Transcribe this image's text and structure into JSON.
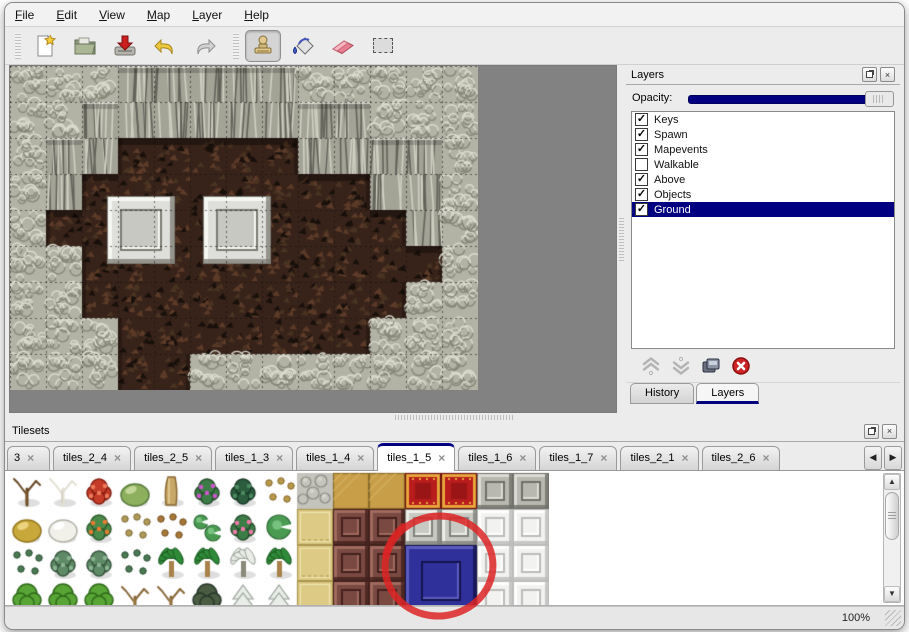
{
  "menu": {
    "items": [
      "File",
      "Edit",
      "View",
      "Map",
      "Layer",
      "Help"
    ]
  },
  "toolbar": {
    "buttons": [
      {
        "name": "new-map"
      },
      {
        "name": "open-map"
      },
      {
        "name": "save-map"
      },
      {
        "name": "undo"
      },
      {
        "name": "redo"
      },
      {
        "name": "stamp-tool"
      },
      {
        "name": "fill-tool"
      },
      {
        "name": "eraser-tool"
      },
      {
        "name": "select-tool"
      }
    ],
    "active_tool": "stamp-tool"
  },
  "layers_panel": {
    "title": "Layers",
    "opacity_label": "Opacity:",
    "items": [
      {
        "label": "Keys",
        "checked": true,
        "selected": false
      },
      {
        "label": "Spawn",
        "checked": true,
        "selected": false
      },
      {
        "label": "Mapevents",
        "checked": true,
        "selected": false
      },
      {
        "label": "Walkable",
        "checked": false,
        "selected": false
      },
      {
        "label": "Above",
        "checked": true,
        "selected": false
      },
      {
        "label": "Objects",
        "checked": true,
        "selected": false
      },
      {
        "label": "Ground",
        "checked": true,
        "selected": true
      }
    ],
    "buttons": [
      {
        "name": "move-layer-up",
        "disabled": true
      },
      {
        "name": "move-layer-down",
        "disabled": true
      },
      {
        "name": "duplicate-layer",
        "disabled": false
      },
      {
        "name": "delete-layer",
        "disabled": false
      }
    ],
    "tabs": [
      "History",
      "Layers"
    ],
    "active_tab": "Layers"
  },
  "tilesets_panel": {
    "title": "Tilesets",
    "tabs": [
      {
        "label": "3",
        "narrow": true
      },
      {
        "label": "tiles_2_4"
      },
      {
        "label": "tiles_2_5"
      },
      {
        "label": "tiles_1_3"
      },
      {
        "label": "tiles_1_4"
      },
      {
        "label": "tiles_1_5"
      },
      {
        "label": "tiles_1_6"
      },
      {
        "label": "tiles_1_7"
      },
      {
        "label": "tiles_2_1"
      },
      {
        "label": "tiles_2_6"
      }
    ],
    "active_tab": "tiles_1_5"
  },
  "statusbar": {
    "zoom": "100%"
  },
  "glyphs": {
    "close": "×",
    "check": "✓",
    "left": "◀",
    "right": "▶",
    "up": "▲",
    "down": "▼"
  },
  "map": {
    "tile_size": 36,
    "grid": [
      "GGGCCCCCGGGGG",
      "GGCCCCCCCCGGG",
      "GCCBBBBBCCCCG",
      "GCBBBBBBBBCCG",
      "GBBBBBBBBBBCG",
      "GGBBBBBBBBBBG",
      "GGBBBBBBBBBGG",
      "GGGBBBBBBBGGG",
      "GGGBBGGGGGGGG"
    ],
    "pillars": [
      {
        "x": 97,
        "y": 130
      },
      {
        "x": 193,
        "y": 130
      }
    ],
    "pillar_size": 68,
    "colors": {
      "rock": "#b3b3a5",
      "rock_dark": "#87877a",
      "rock_light": "#dcdccf",
      "cliff": "#a3a396",
      "cliff_dark": "#63635a",
      "cliff_light": "#cfcfc2",
      "floor": "#38231a",
      "floor_light": "#5d3b28",
      "floor_mid": "#4a3322",
      "floor_dark": "#17100b",
      "void": "#828282",
      "grid": "rgba(15,15,15,0.55)",
      "pillar_face": "#dededa",
      "pillar_mid": "#c8c8c2",
      "pillar_light": "#f6f6f2",
      "pillar_dark": "#7c7c74"
    }
  },
  "tileset": {
    "tile_size": 36,
    "rows": [
      [
        "dead",
        "whitetree",
        "red",
        "stump",
        "trunk",
        "purple",
        "fern",
        "sprout",
        "cobble",
        "wood",
        "wood",
        "carpet",
        "carpet",
        "grayt",
        "grayt"
      ],
      [
        "hay",
        "snowmound",
        "orange",
        "dry",
        "leaves",
        "lily",
        "pink",
        "lilybig",
        "mat",
        "brown",
        "brown",
        "grayblk",
        "grayblk",
        "whiteblk",
        "whiteblk"
      ],
      [
        "sprigs",
        "bush",
        "bush",
        "sprigs",
        "palm",
        "palm",
        "palmsnow",
        "palm",
        "mat",
        "brown",
        "brown",
        "skip",
        "skip",
        "whiteblk",
        "whiteblk"
      ],
      [
        "gtree",
        "gtree",
        "gtree",
        "twist",
        "twist",
        "dtree",
        "firsnow",
        "firsnow",
        "mat",
        "brown",
        "brown",
        "skip",
        "skip",
        "whiteblk",
        "whiteblk"
      ]
    ],
    "blocks": [
      {
        "col": 11,
        "row": 2,
        "w": 2,
        "h": 2,
        "kind": "blue"
      }
    ],
    "kinds": {
      "dead": {
        "shape": "bare",
        "c1": "#6b4a26",
        "c2": "#3f2a12",
        "c3": "#8a6a3a"
      },
      "whitetree": {
        "shape": "bare",
        "c1": "#e4e0d4",
        "c2": "#a8a49a",
        "c3": "#c8c4b8"
      },
      "red": {
        "shape": "blob",
        "c1": "#c43c28",
        "c2": "#821c10",
        "c3": "#ee7a5a"
      },
      "stump": {
        "shape": "mound",
        "c1": "#8cb05e",
        "c2": "#55783a",
        "c3": "#c2d698"
      },
      "trunk": {
        "shape": "trunkv",
        "c1": "#c8a868",
        "c2": "#8a6a34",
        "c3": "#e6d098"
      },
      "purple": {
        "shape": "blob",
        "c1": "#3c7c46",
        "c2": "#234d2a",
        "c3": "#cc58cc"
      },
      "fern": {
        "shape": "blob",
        "c1": "#2c5c3e",
        "c2": "#183826",
        "c3": "#4a8a5e"
      },
      "sprout": {
        "shape": "sprigs",
        "c1": "#b89a4a",
        "c2": "#86692a",
        "c3": "#d8c27a"
      },
      "hay": {
        "shape": "mound",
        "c1": "#c8a83a",
        "c2": "#93751c",
        "c3": "#ecd47e"
      },
      "snowmound": {
        "shape": "mound",
        "c1": "#f1f1ea",
        "c2": "#b2b2a8",
        "c3": "#ffffff"
      },
      "orange": {
        "shape": "blob",
        "c1": "#4a8a4a",
        "c2": "#2b5a2b",
        "c3": "#e87c30"
      },
      "dry": {
        "shape": "sprigs",
        "c1": "#b09a5a",
        "c2": "#7e6a34",
        "c3": "#d4c088"
      },
      "leaves": {
        "shape": "sprigs",
        "c1": "#a87838",
        "c2": "#74501e",
        "c3": "#cc9c5c"
      },
      "lily": {
        "shape": "lily",
        "c1": "#4a9a52",
        "c2": "#2c6a34",
        "c3": "#78c280"
      },
      "pink": {
        "shape": "blob",
        "c1": "#3c7c46",
        "c2": "#234d2a",
        "c3": "#ee7aa8"
      },
      "lilybig": {
        "shape": "lilybig",
        "c1": "#4a9a52",
        "c2": "#2c6a34",
        "c3": "#78c280"
      },
      "bush": {
        "shape": "blob",
        "c1": "#5e8a66",
        "c2": "#35523c",
        "c3": "#8ab492"
      },
      "sprigs": {
        "shape": "sprigs",
        "c1": "#4a7a52",
        "c2": "#2c4e34",
        "c3": "#74a47c"
      },
      "palm": {
        "shape": "palm",
        "c1": "#2f8a38",
        "c2": "#1a5a20",
        "c3": "#a8824a"
      },
      "palmsnow": {
        "shape": "palm",
        "c1": "#e9ede6",
        "c2": "#9aa29a",
        "c3": "#8a8a7a"
      },
      "gtree": {
        "shape": "tree",
        "c1": "#58a434",
        "c2": "#2f6a1a",
        "c3": "#7a5a33"
      },
      "dtree": {
        "shape": "tree",
        "c1": "#4a5c42",
        "c2": "#28362a",
        "c3": "#56462e"
      },
      "twist": {
        "shape": "bare",
        "c1": "#8a6a3a",
        "c2": "#54401e",
        "c3": "#b09058"
      },
      "firsnow": {
        "shape": "fir",
        "c1": "#e9ede8",
        "c2": "#9aa29a",
        "c3": "#3a5a3c"
      },
      "cobble": {
        "shape": "cobble",
        "c1": "#c4c4bc",
        "c2": "#8a8a82",
        "c3": "#e4e4dc"
      },
      "wood": {
        "shape": "tile",
        "c1": "#c89e48",
        "c2": "#8a6a28",
        "c3": "#e2c678"
      },
      "mat": {
        "shape": "mat",
        "c1": "#ddca84",
        "c2": "#ab9750",
        "c3": "#f0e3b0"
      },
      "brown": {
        "shape": "bevel",
        "face": "#7a4a42",
        "mid": "#6a3e38",
        "dark": "#43211d",
        "light": "#a06a5e"
      },
      "carpet": {
        "shape": "carpet",
        "c1": "#b81c1c",
        "c2": "#6e0e0e",
        "c3": "#e8a83c"
      },
      "grayt": {
        "shape": "bevel",
        "face": "#b8b8b0",
        "mid": "#a8a8a0",
        "dark": "#70706a",
        "light": "#dcdcd4"
      },
      "grayblk": {
        "shape": "bevel",
        "face": "#c9c9c3",
        "mid": "#b9b9b3",
        "dark": "#82827c",
        "light": "#eeeee8"
      },
      "blue": {
        "shape": "bevel",
        "face": "#30309a",
        "mid": "#2828864",
        "dark": "#141450",
        "light": "#5c5cc0"
      },
      "whiteblk": {
        "shape": "bevel",
        "face": "#f2f2f0",
        "mid": "#e4e4e2",
        "dark": "#bcbcba",
        "light": "#ffffff"
      },
      "skip": {
        "shape": "none"
      }
    }
  },
  "annotation": {
    "type": "circle",
    "color": "#dd2424"
  }
}
